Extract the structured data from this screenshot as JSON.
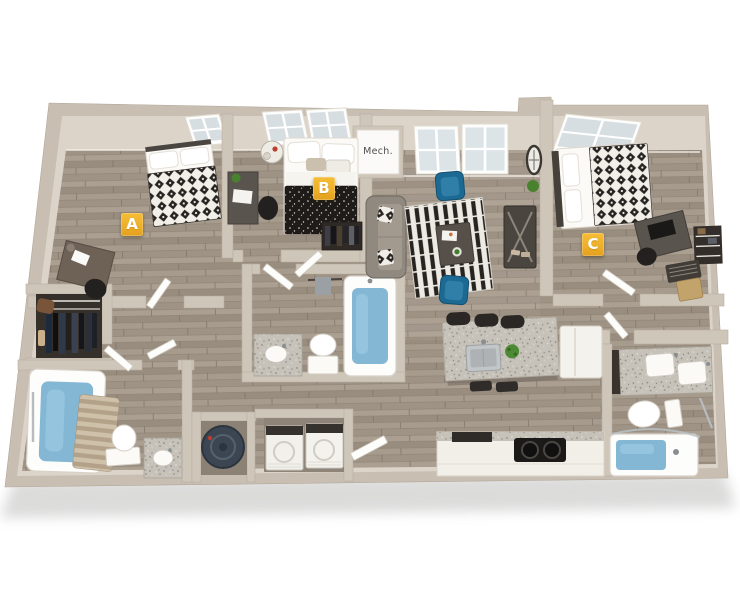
{
  "labels": {
    "bedroom_a": "A",
    "bedroom_b": "B",
    "bedroom_c": "C",
    "mech_closet": "Mech."
  },
  "colors": {
    "background": "#FFFFFF",
    "badge_background": "#EEB02A",
    "badge_text": "#FFFFFF",
    "wall": "#C8BEB2",
    "wall_face": "#DCD4C9",
    "floor_wood": "#A2978A",
    "bath_water_blue": "#83B7D3",
    "armchair_blue": "#1C6A94",
    "rug_stripe_dark": "#262321",
    "bed_pattern_dark": "#262220",
    "granite": "#C6C2B9"
  }
}
